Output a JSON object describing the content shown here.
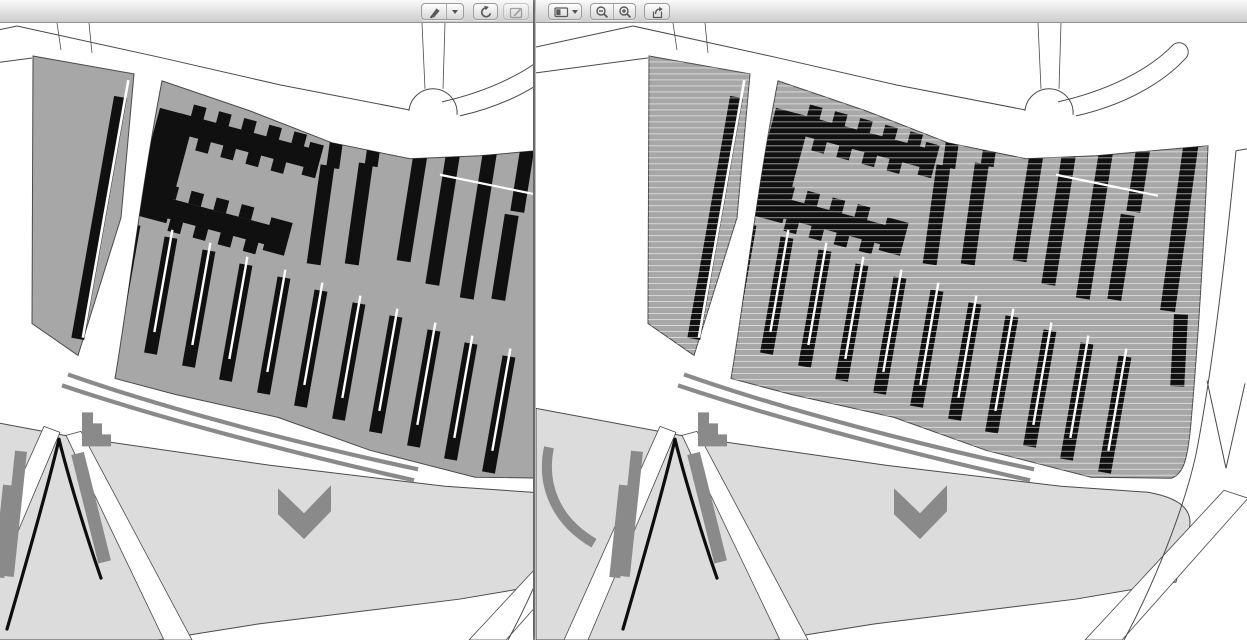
{
  "windows": {
    "left": {
      "role": "document-viewer-window",
      "content": "site-plan-map",
      "toolbar": {
        "buttons": [
          {
            "id": "annotate",
            "icon": "marker-pen-icon",
            "dropdown": true,
            "disabled": false
          },
          {
            "id": "rotate-left",
            "icon": "rotate-left-icon",
            "dropdown": false,
            "disabled": false
          },
          {
            "id": "markup",
            "icon": "markup-pencil-icon",
            "dropdown": false,
            "disabled": true
          }
        ]
      }
    },
    "right": {
      "role": "document-viewer-window",
      "content": "site-plan-map-hatched",
      "toolbar": {
        "buttons": [
          {
            "id": "view-mode",
            "icon": "sidebar-view-icon",
            "dropdown": true,
            "disabled": false
          },
          {
            "id": "zoom-out",
            "icon": "zoom-out-icon",
            "dropdown": false,
            "disabled": false
          },
          {
            "id": "zoom-in",
            "icon": "zoom-in-icon",
            "dropdown": false,
            "disabled": false
          },
          {
            "id": "share",
            "icon": "share-icon",
            "dropdown": false,
            "disabled": false
          }
        ]
      }
    }
  },
  "colors": {
    "line": "#4a4a4a",
    "parcel": "#a7a7a7",
    "park": "#dcdcdc",
    "building": "#101010",
    "feature": "#8a8a8a",
    "white": "#ffffff",
    "icon": "#5a5a5a",
    "toolbar-top": "#fafafa",
    "toolbar-bottom": "#cdcdcd",
    "toolbar-border": "#8f8f8f",
    "btn-top": "#fefefe",
    "btn-bottom": "#d6d6d6",
    "btn-border": "#9b9b9b"
  }
}
